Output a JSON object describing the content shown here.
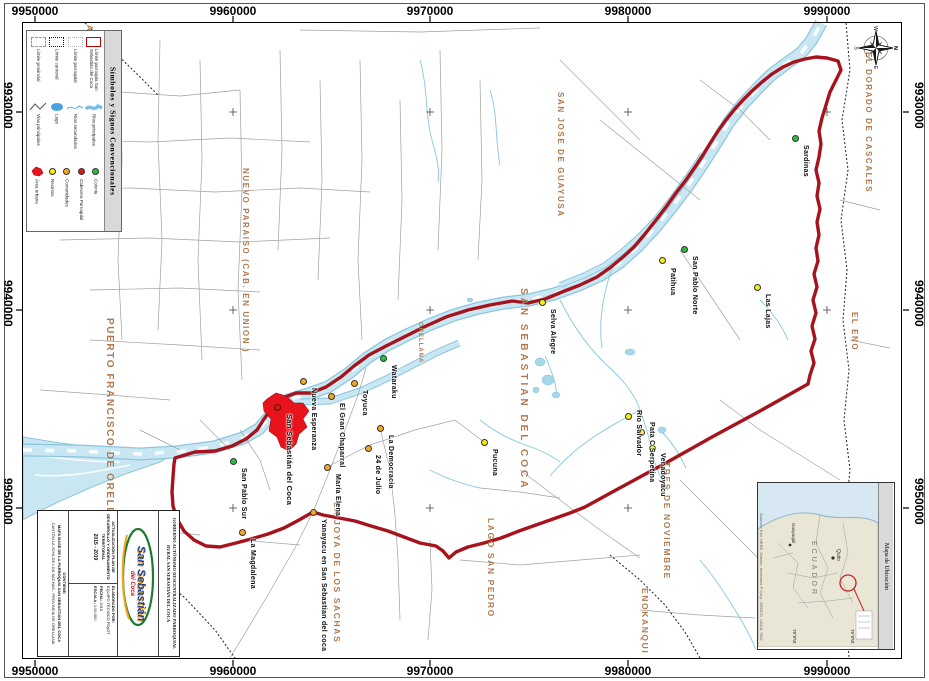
{
  "grid": {
    "top": [
      "9950000",
      "9960000",
      "9970000",
      "9980000",
      "9990000"
    ],
    "bottom": [
      "9950000",
      "9960000",
      "9970000",
      "9980000",
      "9990000"
    ],
    "left": [
      "9930000",
      "9940000",
      "9950000"
    ],
    "right": [
      "9930000",
      "9940000",
      "9950000"
    ]
  },
  "compass": {
    "n": "N",
    "e": "E",
    "s": "S",
    "w": "W"
  },
  "legend": {
    "title": "Símbolos y Signos Convencionales",
    "boundary_items": [
      "Límite provincial",
      "Límite cantonal",
      "Límite parroquial",
      "Límite parroquia San Sebastián del Coca"
    ],
    "line_items": [
      "Vías principales",
      "Lago",
      "Ríos secundarios",
      "Ríos principales"
    ],
    "point_items": [
      "Área urbana",
      "Recintos",
      "Comunidades",
      "Cabecera Parroquial",
      "Colonia"
    ]
  },
  "map": {
    "region_labels": [
      {
        "text": "SAN JOSE DE GUAYUSA"
      },
      {
        "text": "EL DORADO DE CASCALES"
      },
      {
        "text": "EL ENO"
      },
      {
        "text": "TRES DE NOVIEMBRE"
      },
      {
        "text": "ENOKANQUI"
      },
      {
        "text": "LAGO SAN PEDRO"
      },
      {
        "text": "LA JOYA DE LOS SACHAS"
      },
      {
        "text": "SAN CARLOS"
      },
      {
        "text": "PUERTO FRANCISCO DE ORELLANA"
      },
      {
        "text": "NUEVO PARAISO (CAB. EN UNION )"
      },
      {
        "text": "SAN SEBASTIAN DEL COCA"
      },
      {
        "text": "ORELLANA"
      },
      {
        "text": "SA"
      },
      {
        "text": "S"
      }
    ],
    "settlements": [
      {
        "name": "Sardinas",
        "type": "colonia"
      },
      {
        "name": "Las Lajas",
        "type": "recinto"
      },
      {
        "name": "San Pablo Norte",
        "type": "colonia"
      },
      {
        "name": "Patihua",
        "type": "recinto"
      },
      {
        "name": "Selva Alegre",
        "type": "recinto"
      },
      {
        "name": "Wataraku",
        "type": "colonia"
      },
      {
        "name": "Toyuca",
        "type": "comunidad"
      },
      {
        "name": "Nueva Esperanza",
        "type": "comunidad"
      },
      {
        "name": "San Sebastián del Coca",
        "type": "cabecera"
      },
      {
        "name": "El Gran Chaparral",
        "type": "comunidad"
      },
      {
        "name": "María Elena",
        "type": "comunidad"
      },
      {
        "name": "La Democracia",
        "type": "comunidad"
      },
      {
        "name": "24 de Julio",
        "type": "comunidad"
      },
      {
        "name": "Pucuna",
        "type": "recinto"
      },
      {
        "name": "Río Salvador",
        "type": "recinto"
      },
      {
        "name": "Pata C Serpetina",
        "type": "recinto"
      },
      {
        "name": "Venadoyacu",
        "type": "recinto"
      },
      {
        "name": "San Pablo Sur",
        "type": "colonia"
      },
      {
        "name": "La Magdalena",
        "type": "comunidad"
      },
      {
        "name": "Yanayacu en San Sebastian del coca",
        "type": "comunidad"
      }
    ]
  },
  "titleblock": {
    "institution": "GOBIERNO AUTÓNOMO DESCENTRALIZADO PARROQUIAL RURAL SAN SEBASTIÁN DEL COCA",
    "project": "ACTUALIZACIÓN PLAN DE DESARROLLO Y ORDENAMIENTO TERRITORIAL",
    "period": "2015 - 2019",
    "elaborated_label": "ELABORADO POR:",
    "elaborated": "EQUIPO TÉCNICO PDyOT",
    "date_label": "FECHA:",
    "date": "2015",
    "scale_label": "ESCALA:",
    "scale": "1:50.000",
    "contains_label": "CONTIENE:",
    "contains": "MAPA BASE DE LA PARROQUIA SAN SEBASTIÁN DEL COCA",
    "location": "CANTÓN LA JOYA DE LOS SACHAS - PROVINCIA DE ORELLANA",
    "logo_line1": "San Sebastián",
    "logo_line2": "del Coca"
  },
  "inset": {
    "title": "Mapa de Ubicación",
    "country": "ECUADOR",
    "capital": "Quito",
    "city": "Guayaquil",
    "attribution": "Sources: Esri, HERE, Garmin, Increment P Corp., GEBCO, USGS, FAO",
    "coord_left": "78°0'W",
    "coord_right": "76°0'W"
  },
  "colors": {
    "boundary_red": "#a6131c",
    "urban_red": "#e8131c",
    "river_fill": "#c9e7f3",
    "river_edge": "#8cc6dc",
    "region_label": "#b07a50",
    "recinto_yellow": "#f7ef0f",
    "comunidad_orange": "#f6a71f",
    "colonia_green": "#28bf3f",
    "cabecera_red": "#e01616"
  }
}
